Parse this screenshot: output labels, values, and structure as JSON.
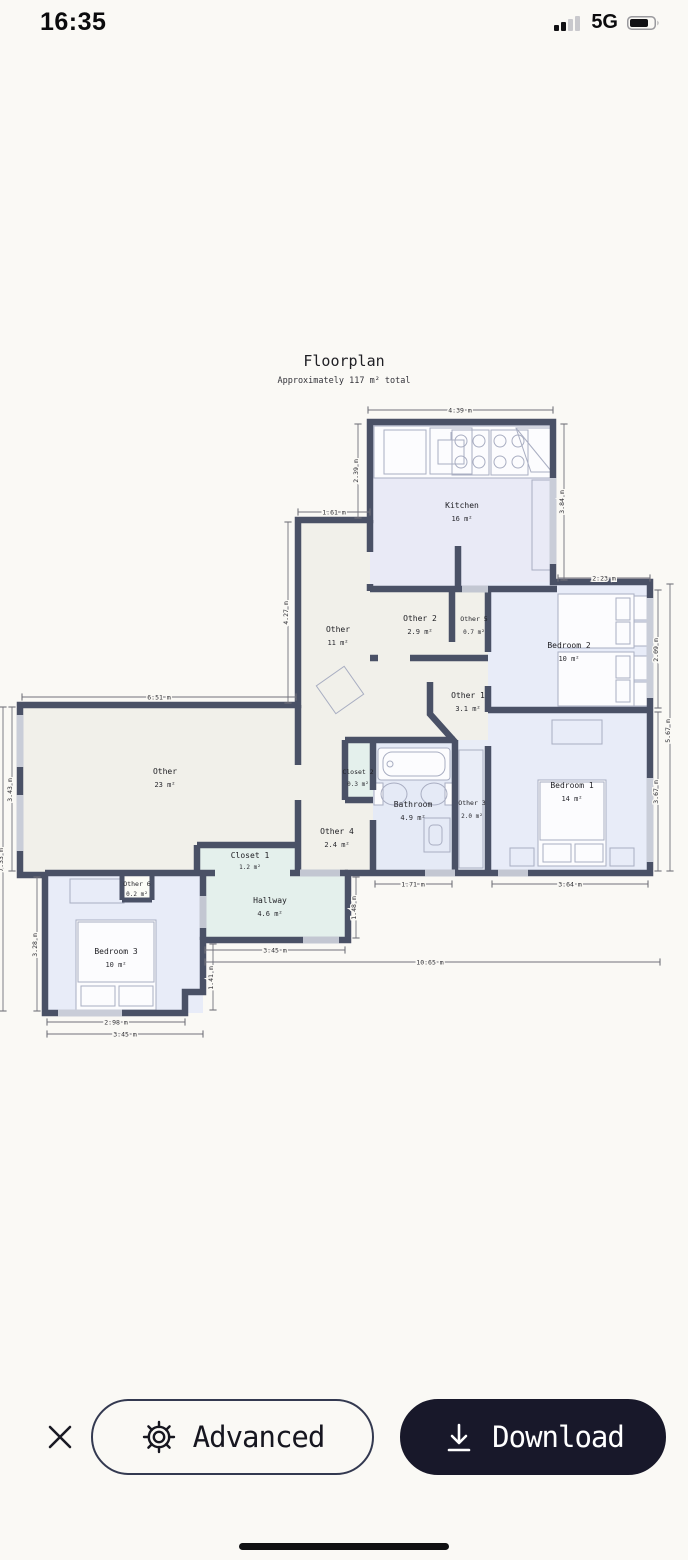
{
  "status_bar": {
    "time": "16:35",
    "network": "5G"
  },
  "floorplan": {
    "title": "Floorplan",
    "subtitle": "Approximately 117 m² total",
    "rooms": {
      "kitchen": {
        "name": "Kitchen",
        "area": "16 m²"
      },
      "entry": {
        "name": "Other",
        "area": "11 m²"
      },
      "other2": {
        "name": "Other 2",
        "area": "2.9 m²"
      },
      "other5": {
        "name": "Other 5",
        "area": "0.7 m²"
      },
      "bedroom2": {
        "name": "Bedroom 2",
        "area": "10 m²"
      },
      "other1": {
        "name": "Other 1",
        "area": "3.1 m²"
      },
      "living": {
        "name": "Other",
        "area": "23 m²"
      },
      "closet2": {
        "name": "Closet 2",
        "area": "0.3 m²"
      },
      "bathroom": {
        "name": "Bathroom",
        "area": "4.9 m²"
      },
      "other3": {
        "name": "Other 3",
        "area": "2.0 m²"
      },
      "bedroom1": {
        "name": "Bedroom 1",
        "area": "14 m²"
      },
      "other4": {
        "name": "Other 4",
        "area": "2.4 m²"
      },
      "closet1": {
        "name": "Closet 1",
        "area": "1.2 m²"
      },
      "other6": {
        "name": "Other 6",
        "area": "0.2 m²"
      },
      "hallway": {
        "name": "Hallway",
        "area": "4.6 m²"
      },
      "bedroom3": {
        "name": "Bedroom 3",
        "area": "10 m²"
      }
    },
    "dimensions": {
      "kitchen_width": "4.39 m",
      "kitchen_left_height": "2.39 m",
      "kitchen_right_height": "3.84 m",
      "entry_width": "1.61 m",
      "entry_height": "4.27 m",
      "bedroom2_top_width": "2.23 m",
      "bedroom2_right_height": "2.09 m",
      "bedroom1_right_height": "3.67 m",
      "right_total_height": "5.67 m",
      "living_width": "6.51 m",
      "living_left_height": "3.43 m",
      "left_total_height": "7.33 m",
      "bathroom_bottom_width": "1.71 m",
      "bedroom1_bottom_width": "3.64 m",
      "hallway_bottom_width": "3.45 m",
      "bottom_total_width": "10.65 m",
      "hallway_right_height": "1.48 m",
      "bedroom3_right_height": "1.41 m",
      "bedroom3_left_height": "3.28 m",
      "bedroom3_bottom_inner": "2.98 m",
      "bedroom3_bottom_outer": "3.45 m"
    }
  },
  "actions": {
    "advanced_label": "Advanced",
    "download_label": "Download"
  },
  "colors": {
    "wall": "#4a5166",
    "room_beige": "#f1f0ea",
    "room_lavender": "#e9eaf6",
    "room_blue": "#e8ecf8",
    "room_mint": "#e4f0ec",
    "download_button": "#18182a"
  }
}
